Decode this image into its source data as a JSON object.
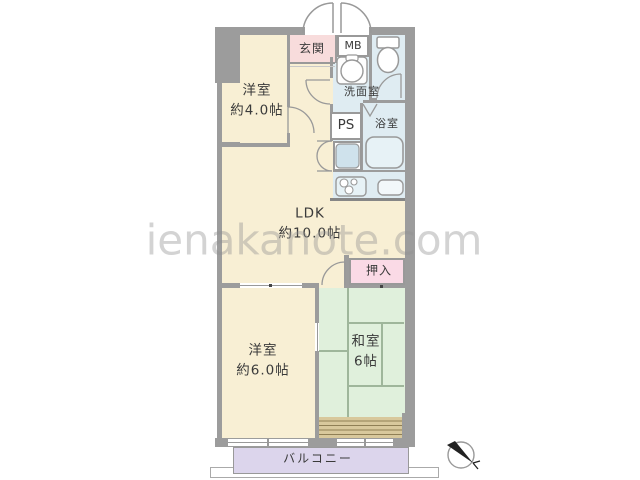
{
  "floorplan": {
    "watermark": "ienakanote.com",
    "rooms": {
      "entrance": {
        "label": "玄関"
      },
      "meter_box": {
        "label": "MB"
      },
      "washroom": {
        "label": "洗面室"
      },
      "western_room_4": {
        "label": "洋室",
        "size": "約4.0帖"
      },
      "pipe_space": {
        "label": "PS"
      },
      "bathroom": {
        "label": "浴室"
      },
      "ldk": {
        "label": "LDK",
        "size": "約10.0帖"
      },
      "closet": {
        "label": "押入"
      },
      "western_room_6": {
        "label": "洋室",
        "size": "約6.0帖"
      },
      "japanese_room": {
        "label": "和室",
        "size": "6帖"
      },
      "balcony": {
        "label": "バルコニー"
      }
    },
    "colors": {
      "wall": "#9c9c9c",
      "room_cream": "#f8efd4",
      "entrance_pink": "#f8dcdc",
      "closet_pink": "#fadae6",
      "wet_area_blue": "#dfecf2",
      "tatami_green": "#e0f0dc",
      "balcony_purple": "#dcd5ec",
      "veranda_tan": "#d8c89c",
      "watermark_gray": "#c8c8c8"
    }
  }
}
